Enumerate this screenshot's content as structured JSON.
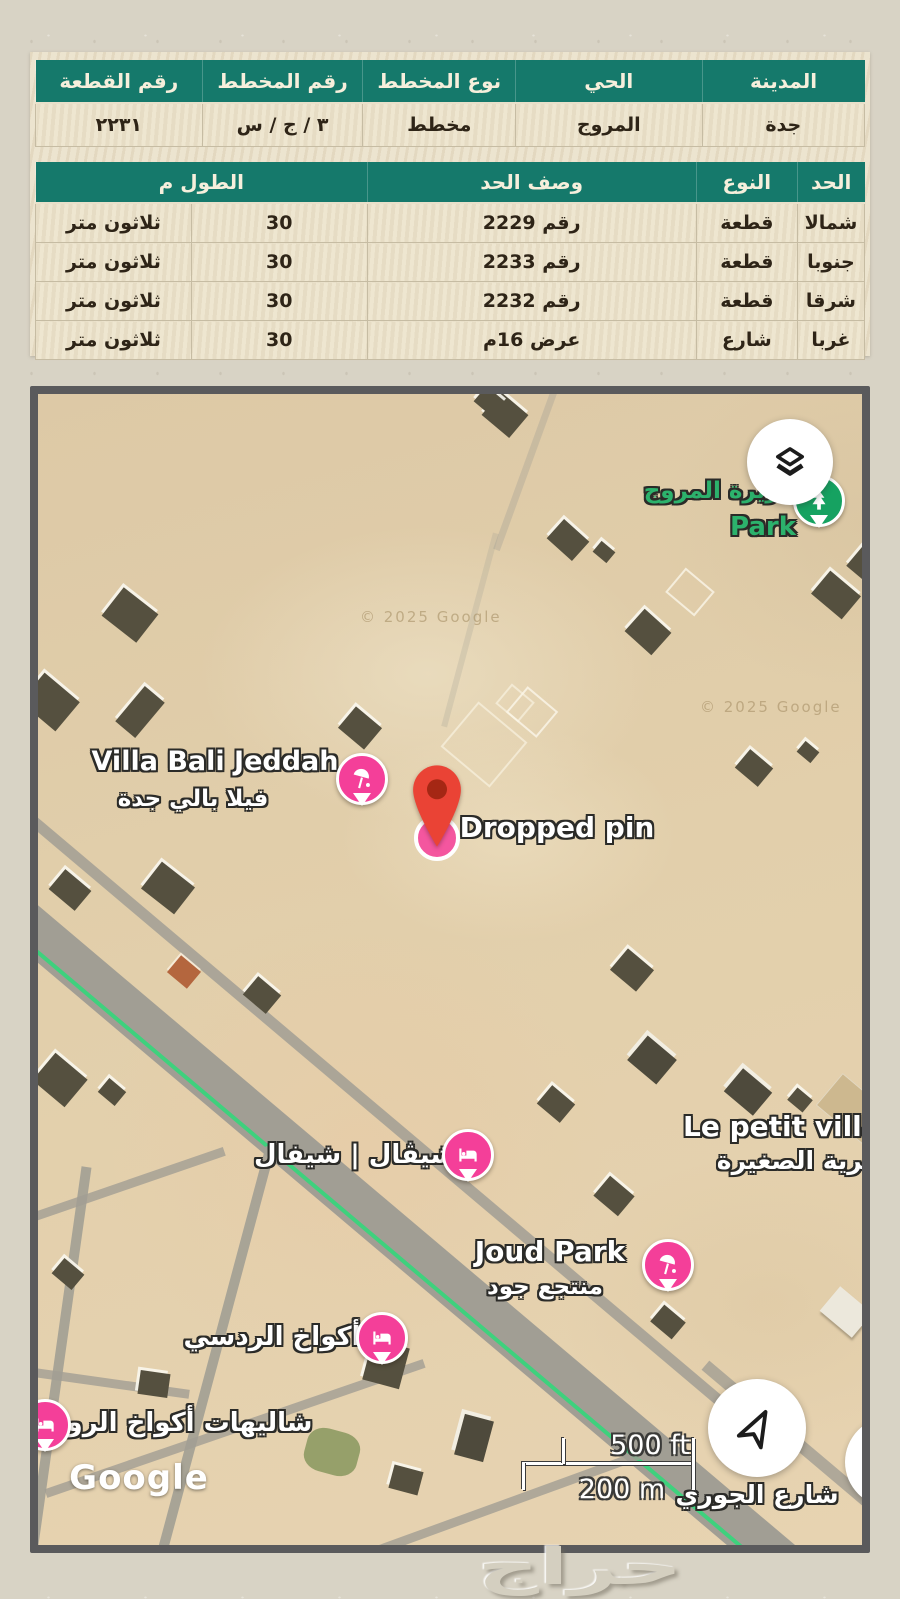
{
  "page": {
    "watermark": "حراج"
  },
  "plot_table": {
    "headers": [
      "المدينة",
      "الحي",
      "نوع المخطط",
      "رقم المخطط",
      "رقم القطعة"
    ],
    "values": [
      "جدة",
      "المروج",
      "مخطط",
      "٣ / ج / س",
      "٢٢٣١"
    ]
  },
  "bounds_table": {
    "headers": [
      "الحد",
      "النوع",
      "وصف الحد",
      "الطول م"
    ],
    "rows": [
      {
        "side": "شمالا",
        "type": "قطعة",
        "desc": "رقم 2229",
        "len": "30",
        "len_text": "ثلاثون متر"
      },
      {
        "side": "جنوبا",
        "type": "قطعة",
        "desc": "رقم 2233",
        "len": "30",
        "len_text": "ثلاثون متر"
      },
      {
        "side": "شرقا",
        "type": "قطعة",
        "desc": "رقم 2232",
        "len": "30",
        "len_text": "ثلاثون متر"
      },
      {
        "side": "غربا",
        "type": "شارع",
        "desc": "عرض 16م",
        "len": "30",
        "len_text": "ثلاثون متر"
      }
    ]
  },
  "map": {
    "copyright_left": "© 2025 Google",
    "copyright_right": "© 2025 Google",
    "google_logo": "Google",
    "scale": {
      "imperial": "500 ft",
      "metric": "200 m"
    },
    "street_label": "شارع الجوري",
    "pois": {
      "park": {
        "title": "جزيرة المروج",
        "subtitle": "Park"
      },
      "villa_bali": {
        "title": "Villa Bali Jeddah",
        "subtitle": "فيلا بالي جدة"
      },
      "dropped_pin": {
        "title": "Dropped pin"
      },
      "cheval": {
        "title": "شيڤال | شيفال"
      },
      "petit_village": {
        "title": "Le petit village",
        "subtitle": "قرية الصغيرة"
      },
      "joud_park": {
        "title": "Joud Park",
        "subtitle": "منتجع جود"
      },
      "akwakh": {
        "title": "أكواخ الردسي"
      },
      "chalets": {
        "title": "شاليهات أكواخ الروز"
      }
    }
  },
  "colors": {
    "table_header": "#15796b",
    "pin_pink": "#f43f99",
    "pin_red": "#ea4335",
    "park_green": "#16a261",
    "transit_green": "#3ed17d"
  }
}
